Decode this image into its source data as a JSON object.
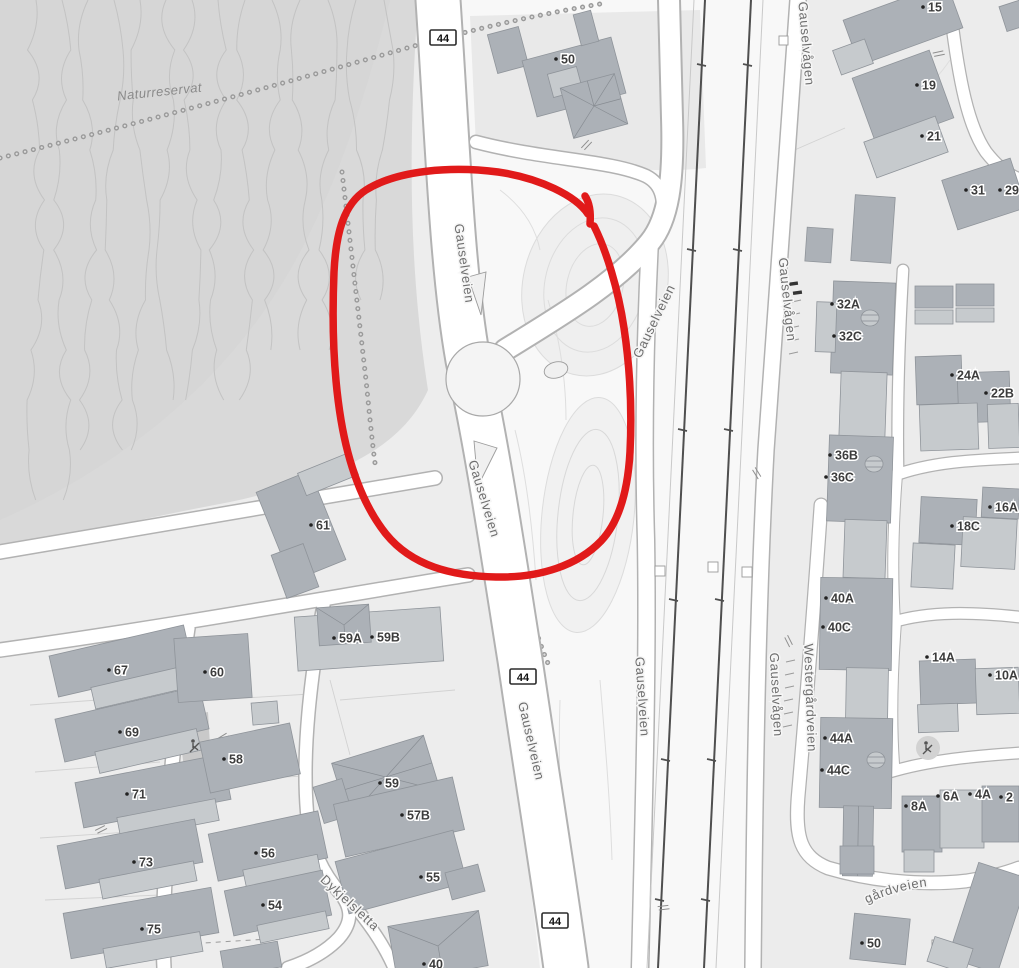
{
  "map": {
    "colors": {
      "background": "#ededed",
      "terrain": "#d9d9d9",
      "road": "#ffffff",
      "building_dark": "#acb1b7",
      "building_light": "#c6cacd",
      "railway": "#4f4f4f",
      "label_gray": "#6e6e6e",
      "annotation_red": "#e11a1a"
    },
    "region_labels": [
      {
        "text": "Naturreservat",
        "x": 160,
        "y": 96,
        "rotation": -6
      }
    ],
    "road_labels": [
      {
        "text": "Gauselveien",
        "x": 460,
        "y": 264,
        "rotation": 82
      },
      {
        "text": "Gauselveien",
        "x": 480,
        "y": 500,
        "rotation": 73
      },
      {
        "text": "Gauselveien",
        "x": 527,
        "y": 742,
        "rotation": 77
      },
      {
        "text": "Gauselveien",
        "x": 658,
        "y": 323,
        "rotation": -64
      },
      {
        "text": "Gauselveien",
        "x": 638,
        "y": 697,
        "rotation": 86
      },
      {
        "text": "Gauselvågen",
        "x": 802,
        "y": 44,
        "rotation": 85
      },
      {
        "text": "Gauselvågen",
        "x": 783,
        "y": 300,
        "rotation": 84
      },
      {
        "text": "Gauselvågen",
        "x": 772,
        "y": 695,
        "rotation": 87
      },
      {
        "text": "Westergårdveien",
        "x": 806,
        "y": 698,
        "rotation": 88
      },
      {
        "text": "Dykjelsletta",
        "x": 347,
        "y": 906,
        "rotation": 43
      }
    ],
    "curved_road_label": {
      "text": "Westergårdveien"
    },
    "route_markers": [
      {
        "text": "44",
        "x": 443,
        "y": 38
      },
      {
        "text": "44",
        "x": 523,
        "y": 677
      },
      {
        "text": "44",
        "x": 555,
        "y": 921
      }
    ],
    "house_numbers": [
      {
        "text": "50",
        "x": 556,
        "y": 59
      },
      {
        "text": "15",
        "x": 923,
        "y": 7
      },
      {
        "text": "19",
        "x": 917,
        "y": 85
      },
      {
        "text": "21",
        "x": 922,
        "y": 136
      },
      {
        "text": "31",
        "x": 966,
        "y": 190
      },
      {
        "text": "29",
        "x": 1000,
        "y": 190
      },
      {
        "text": "32A",
        "x": 832,
        "y": 304
      },
      {
        "text": "32C",
        "x": 834,
        "y": 336
      },
      {
        "text": "24A",
        "x": 952,
        "y": 375
      },
      {
        "text": "22B",
        "x": 986,
        "y": 393
      },
      {
        "text": "36B",
        "x": 830,
        "y": 455
      },
      {
        "text": "36C",
        "x": 826,
        "y": 477
      },
      {
        "text": "16A",
        "x": 990,
        "y": 507
      },
      {
        "text": "18C",
        "x": 952,
        "y": 526
      },
      {
        "text": "40A",
        "x": 826,
        "y": 598
      },
      {
        "text": "40C",
        "x": 823,
        "y": 627
      },
      {
        "text": "14A",
        "x": 927,
        "y": 657
      },
      {
        "text": "10A",
        "x": 990,
        "y": 675
      },
      {
        "text": "44A",
        "x": 825,
        "y": 738
      },
      {
        "text": "44C",
        "x": 822,
        "y": 770
      },
      {
        "text": "8A",
        "x": 906,
        "y": 806
      },
      {
        "text": "6A",
        "x": 938,
        "y": 796
      },
      {
        "text": "4A",
        "x": 970,
        "y": 794
      },
      {
        "text": "2",
        "x": 1001,
        "y": 797
      },
      {
        "text": "50",
        "x": 862,
        "y": 943
      },
      {
        "text": "61",
        "x": 311,
        "y": 525
      },
      {
        "text": "59A",
        "x": 334,
        "y": 638
      },
      {
        "text": "59B",
        "x": 372,
        "y": 637
      },
      {
        "text": "67",
        "x": 109,
        "y": 670
      },
      {
        "text": "60",
        "x": 205,
        "y": 672
      },
      {
        "text": "69",
        "x": 120,
        "y": 732
      },
      {
        "text": "58",
        "x": 224,
        "y": 759
      },
      {
        "text": "71",
        "x": 127,
        "y": 794
      },
      {
        "text": "59",
        "x": 380,
        "y": 783
      },
      {
        "text": "57B",
        "x": 402,
        "y": 815
      },
      {
        "text": "55",
        "x": 421,
        "y": 877
      },
      {
        "text": "73",
        "x": 134,
        "y": 862
      },
      {
        "text": "56",
        "x": 256,
        "y": 853
      },
      {
        "text": "54",
        "x": 263,
        "y": 905
      },
      {
        "text": "75",
        "x": 142,
        "y": 929
      },
      {
        "text": "40",
        "x": 424,
        "y": 964
      }
    ],
    "icons": [
      {
        "name": "playground-icon",
        "x": 928,
        "y": 748,
        "bg": true
      },
      {
        "name": "playground-icon",
        "x": 195,
        "y": 746,
        "bg": false
      }
    ],
    "annotation": {
      "type": "hand-drawn-circle",
      "color": "#e11a1a"
    }
  }
}
